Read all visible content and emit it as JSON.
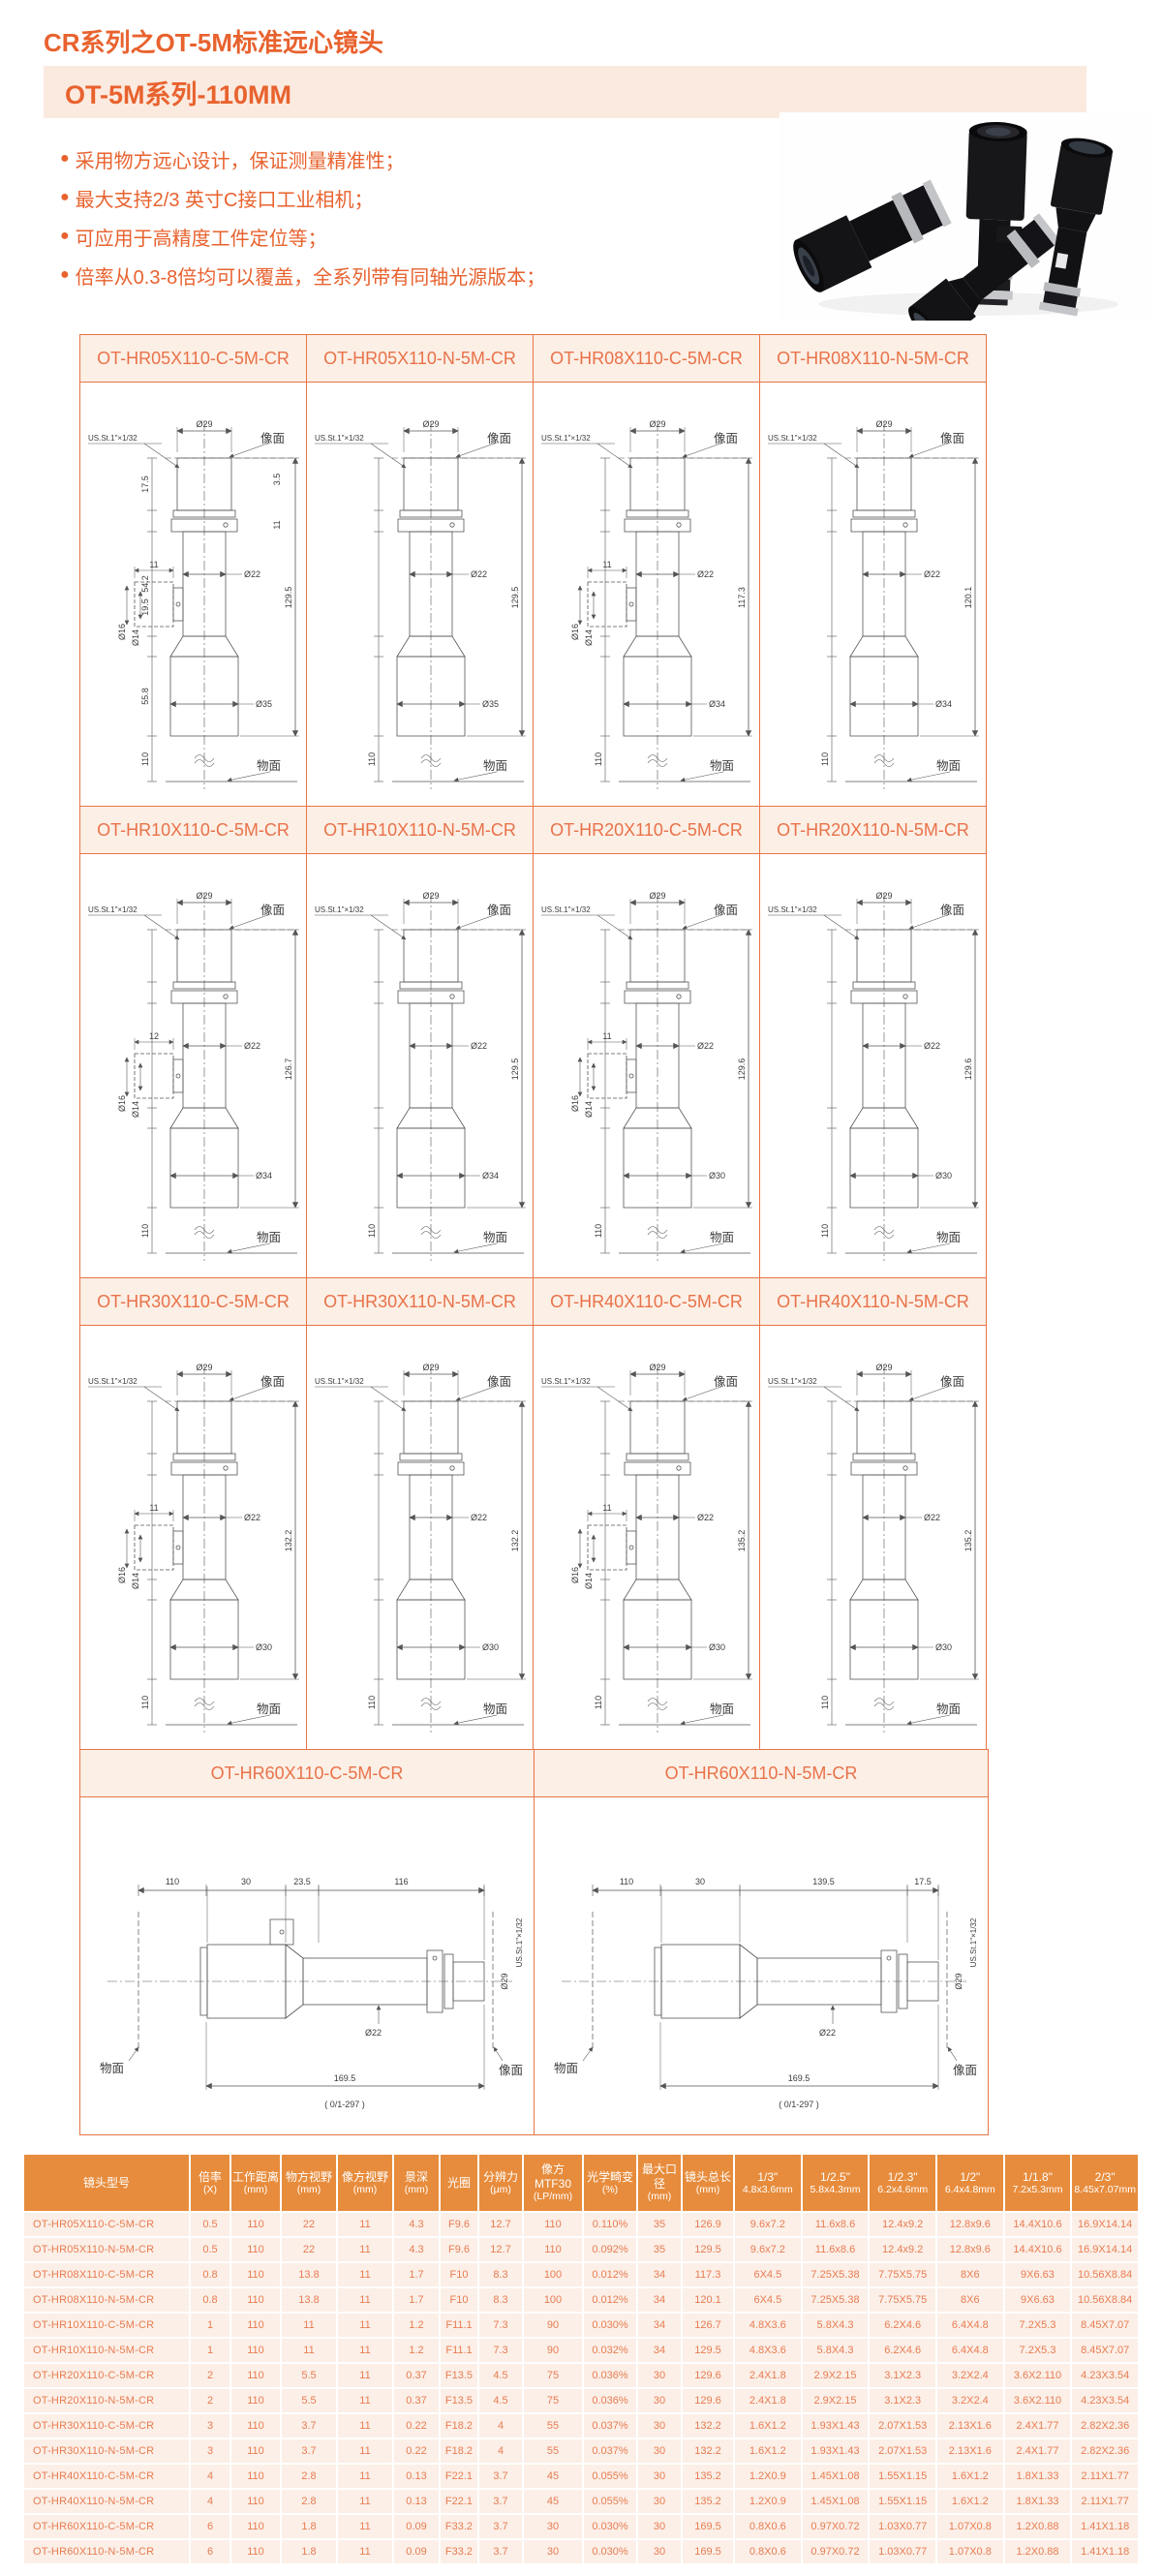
{
  "colors": {
    "accent": "#E8622E",
    "bar_bg": "#FBEADF",
    "grid_border": "#E87447",
    "grid_header_bg": "#FCEFE5",
    "table_header_bg": "#E78C3C",
    "table_cell_bg": "#FBEFE7",
    "table_text": "#E87C52"
  },
  "page": {
    "title": "CR系列之OT-5M标准远心镜头",
    "subtitle": "OT-5M系列-110MM",
    "features": [
      "采用物方远心设计，保证测量精准性；",
      "最大支持2/3 英寸C接口工业相机；",
      "可应用于高精度工件定位等；",
      "倍率从0.3-8倍均可以覆盖，全系列带有同轴光源版本；"
    ]
  },
  "drawing_labels": {
    "image_plane": "像面",
    "object_plane": "物面",
    "thread": "US.St.1\"×1/32",
    "work": "110"
  },
  "grid": {
    "rows": [
      {
        "cells": [
          {
            "model": "OT-HR05X110-C-5M-CR",
            "variant": "C",
            "top_dia": "Ø29",
            "mid_dia": "Ø22",
            "bottom_dia": "Ø35",
            "total": "129.5",
            "left_dims": [
              "17.5",
              "54.2",
              "19.5",
              "55.8"
            ],
            "right_dims": [
              "3.5",
              "11"
            ],
            "side_dims": [
              "11",
              "Ø16",
              "Ø14"
            ]
          },
          {
            "model": "OT-HR05X110-N-5M-CR",
            "variant": "N",
            "top_dia": "Ø29",
            "mid_dia": "Ø22",
            "bottom_dia": "Ø35",
            "total": "129.5"
          },
          {
            "model": "OT-HR08X110-C-5M-CR",
            "variant": "C",
            "top_dia": "Ø29",
            "mid_dia": "Ø22",
            "bottom_dia": "Ø34",
            "total": "117.3",
            "side_dims": [
              "11",
              "Ø16",
              "Ø14"
            ]
          },
          {
            "model": "OT-HR08X110-N-5M-CR",
            "variant": "N",
            "top_dia": "Ø29",
            "mid_dia": "Ø22",
            "bottom_dia": "Ø34",
            "total": "120.1"
          }
        ]
      },
      {
        "cells": [
          {
            "model": "OT-HR10X110-C-5M-CR",
            "variant": "C",
            "top_dia": "Ø29",
            "mid_dia": "Ø22",
            "bottom_dia": "Ø34",
            "total": "126.7",
            "side_dims": [
              "12",
              "Ø16",
              "Ø14"
            ]
          },
          {
            "model": "OT-HR10X110-N-5M-CR",
            "variant": "N",
            "top_dia": "Ø29",
            "mid_dia": "Ø22",
            "bottom_dia": "Ø34",
            "total": "129.5"
          },
          {
            "model": "OT-HR20X110-C-5M-CR",
            "variant": "C",
            "top_dia": "Ø29",
            "mid_dia": "Ø22",
            "bottom_dia": "Ø30",
            "total": "129.6",
            "side_dims": [
              "11",
              "Ø16",
              "Ø14"
            ]
          },
          {
            "model": "OT-HR20X110-N-5M-CR",
            "variant": "N",
            "top_dia": "Ø29",
            "mid_dia": "Ø22",
            "bottom_dia": "Ø30",
            "total": "129.6"
          }
        ]
      },
      {
        "cells": [
          {
            "model": "OT-HR30X110-C-5M-CR",
            "variant": "C",
            "top_dia": "Ø29",
            "mid_dia": "Ø22",
            "bottom_dia": "Ø30",
            "total": "132.2",
            "side_dims": [
              "11",
              "Ø16",
              "Ø14"
            ]
          },
          {
            "model": "OT-HR30X110-N-5M-CR",
            "variant": "N",
            "top_dia": "Ø29",
            "mid_dia": "Ø22",
            "bottom_dia": "Ø30",
            "total": "132.2"
          },
          {
            "model": "OT-HR40X110-C-5M-CR",
            "variant": "C",
            "top_dia": "Ø29",
            "mid_dia": "Ø22",
            "bottom_dia": "Ø30",
            "total": "135.2",
            "side_dims": [
              "11",
              "Ø16",
              "Ø14"
            ]
          },
          {
            "model": "OT-HR40X110-N-5M-CR",
            "variant": "N",
            "top_dia": "Ø29",
            "mid_dia": "Ø22",
            "bottom_dia": "Ø30",
            "total": "135.2"
          }
        ]
      },
      {
        "cells": [
          {
            "model": "OT-HR60X110-C-5M-CR",
            "variant": "C",
            "orient": "h",
            "top_dia": "Ø29",
            "mid_dia": "Ø22",
            "total": "169.5",
            "top_dims": [
              "110",
              "30",
              "23.5",
              "116"
            ],
            "bracket": "( 0/1-297 )"
          },
          {
            "model": "OT-HR60X110-N-5M-CR",
            "variant": "N",
            "orient": "h",
            "top_dia": "Ø29",
            "mid_dia": "Ø22",
            "total": "169.5",
            "top_dims": [
              "110",
              "30",
              "139.5",
              "17.5"
            ],
            "bracket": "( 0/1-297 )"
          }
        ]
      }
    ]
  },
  "table": {
    "headers": [
      {
        "l1": "镜头型号",
        "l2": ""
      },
      {
        "l1": "倍率",
        "l2": "(X)"
      },
      {
        "l1": "工作距离",
        "l2": "(mm)"
      },
      {
        "l1": "物方视野",
        "l2": "(mm)"
      },
      {
        "l1": "像方视野",
        "l2": "(mm)"
      },
      {
        "l1": "景深",
        "l2": "(mm)"
      },
      {
        "l1": "光圈",
        "l2": ""
      },
      {
        "l1": "分辨力",
        "l2": "(μm)"
      },
      {
        "l1": "像方MTF30",
        "l2": "(LP/mm)"
      },
      {
        "l1": "光学畸变",
        "l2": "(%)"
      },
      {
        "l1": "最大口径",
        "l2": "(mm)"
      },
      {
        "l1": "镜头总长",
        "l2": "(mm)"
      },
      {
        "l1": "1/3\"",
        "l2": "4.8x3.6mm"
      },
      {
        "l1": "1/2.5\"",
        "l2": "5.8x4.3mm"
      },
      {
        "l1": "1/2.3\"",
        "l2": "6.2x4.6mm"
      },
      {
        "l1": "1/2\"",
        "l2": "6.4x4.8mm"
      },
      {
        "l1": "1/1.8\"",
        "l2": "7.2x5.3mm"
      },
      {
        "l1": "2/3\"",
        "l2": "8.45x7.07mm"
      }
    ],
    "rows": [
      [
        "OT-HR05X110-C-5M-CR",
        "0.5",
        "110",
        "22",
        "11",
        "4.3",
        "F9.6",
        "12.7",
        "110",
        "0.110%",
        "35",
        "126.9",
        "9.6x7.2",
        "11.6x8.6",
        "12.4x9.2",
        "12.8x9.6",
        "14.4X10.6",
        "16.9X14.14"
      ],
      [
        "OT-HR05X110-N-5M-CR",
        "0.5",
        "110",
        "22",
        "11",
        "4.3",
        "F9.6",
        "12.7",
        "110",
        "0.092%",
        "35",
        "129.5",
        "9.6x7.2",
        "11.6x8.6",
        "12.4x9.2",
        "12.8x9.6",
        "14.4X10.6",
        "16.9X14.14"
      ],
      [
        "OT-HR08X110-C-5M-CR",
        "0.8",
        "110",
        "13.8",
        "11",
        "1.7",
        "F10",
        "8.3",
        "100",
        "0.012%",
        "34",
        "117.3",
        "6X4.5",
        "7.25X5.38",
        "7.75X5.75",
        "8X6",
        "9X6.63",
        "10.56X8.84"
      ],
      [
        "OT-HR08X110-N-5M-CR",
        "0.8",
        "110",
        "13.8",
        "11",
        "1.7",
        "F10",
        "8.3",
        "100",
        "0.012%",
        "34",
        "120.1",
        "6X4.5",
        "7.25X5.38",
        "7.75X5.75",
        "8X6",
        "9X6.63",
        "10.56X8.84"
      ],
      [
        "OT-HR10X110-C-5M-CR",
        "1",
        "110",
        "11",
        "11",
        "1.2",
        "F11.1",
        "7.3",
        "90",
        "0.030%",
        "34",
        "126.7",
        "4.8X3.6",
        "5.8X4.3",
        "6.2X4.6",
        "6.4X4.8",
        "7.2X5.3",
        "8.45X7.07"
      ],
      [
        "OT-HR10X110-N-5M-CR",
        "1",
        "110",
        "11",
        "11",
        "1.2",
        "F11.1",
        "7.3",
        "90",
        "0.032%",
        "34",
        "129.5",
        "4.8X3.6",
        "5.8X4.3",
        "6.2X4.6",
        "6.4X4.8",
        "7.2X5.3",
        "8.45X7.07"
      ],
      [
        "OT-HR20X110-C-5M-CR",
        "2",
        "110",
        "5.5",
        "11",
        "0.37",
        "F13.5",
        "4.5",
        "75",
        "0.036%",
        "30",
        "129.6",
        "2.4X1.8",
        "2.9X2.15",
        "3.1X2.3",
        "3.2X2.4",
        "3.6X2.110",
        "4.23X3.54"
      ],
      [
        "OT-HR20X110-N-5M-CR",
        "2",
        "110",
        "5.5",
        "11",
        "0.37",
        "F13.5",
        "4.5",
        "75",
        "0.036%",
        "30",
        "129.6",
        "2.4X1.8",
        "2.9X2.15",
        "3.1X2.3",
        "3.2X2.4",
        "3.6X2.110",
        "4.23X3.54"
      ],
      [
        "OT-HR30X110-C-5M-CR",
        "3",
        "110",
        "3.7",
        "11",
        "0.22",
        "F18.2",
        "4",
        "55",
        "0.037%",
        "30",
        "132.2",
        "1.6X1.2",
        "1.93X1.43",
        "2.07X1.53",
        "2.13X1.6",
        "2.4X1.77",
        "2.82X2.36"
      ],
      [
        "OT-HR30X110-N-5M-CR",
        "3",
        "110",
        "3.7",
        "11",
        "0.22",
        "F18.2",
        "4",
        "55",
        "0.037%",
        "30",
        "132.2",
        "1.6X1.2",
        "1.93X1.43",
        "2.07X1.53",
        "2.13X1.6",
        "2.4X1.77",
        "2.82X2.36"
      ],
      [
        "OT-HR40X110-C-5M-CR",
        "4",
        "110",
        "2.8",
        "11",
        "0.13",
        "F22.1",
        "3.7",
        "45",
        "0.055%",
        "30",
        "135.2",
        "1.2X0.9",
        "1.45X1.08",
        "1.55X1.15",
        "1.6X1.2",
        "1.8X1.33",
        "2.11X1.77"
      ],
      [
        "OT-HR40X110-N-5M-CR",
        "4",
        "110",
        "2.8",
        "11",
        "0.13",
        "F22.1",
        "3.7",
        "45",
        "0.055%",
        "30",
        "135.2",
        "1.2X0.9",
        "1.45X1.08",
        "1.55X1.15",
        "1.6X1.2",
        "1.8X1.33",
        "2.11X1.77"
      ],
      [
        "OT-HR60X110-C-5M-CR",
        "6",
        "110",
        "1.8",
        "11",
        "0.09",
        "F33.2",
        "3.7",
        "30",
        "0.030%",
        "30",
        "169.5",
        "0.8X0.6",
        "0.97X0.72",
        "1.03X0.77",
        "1.07X0.8",
        "1.2X0.88",
        "1.41X1.18"
      ],
      [
        "OT-HR60X110-N-5M-CR",
        "6",
        "110",
        "1.8",
        "11",
        "0.09",
        "F33.2",
        "3.7",
        "30",
        "0.030%",
        "30",
        "169.5",
        "0.8X0.6",
        "0.97X0.72",
        "1.03X0.77",
        "1.07X0.8",
        "1.2X0.88",
        "1.41X1.18"
      ]
    ]
  }
}
